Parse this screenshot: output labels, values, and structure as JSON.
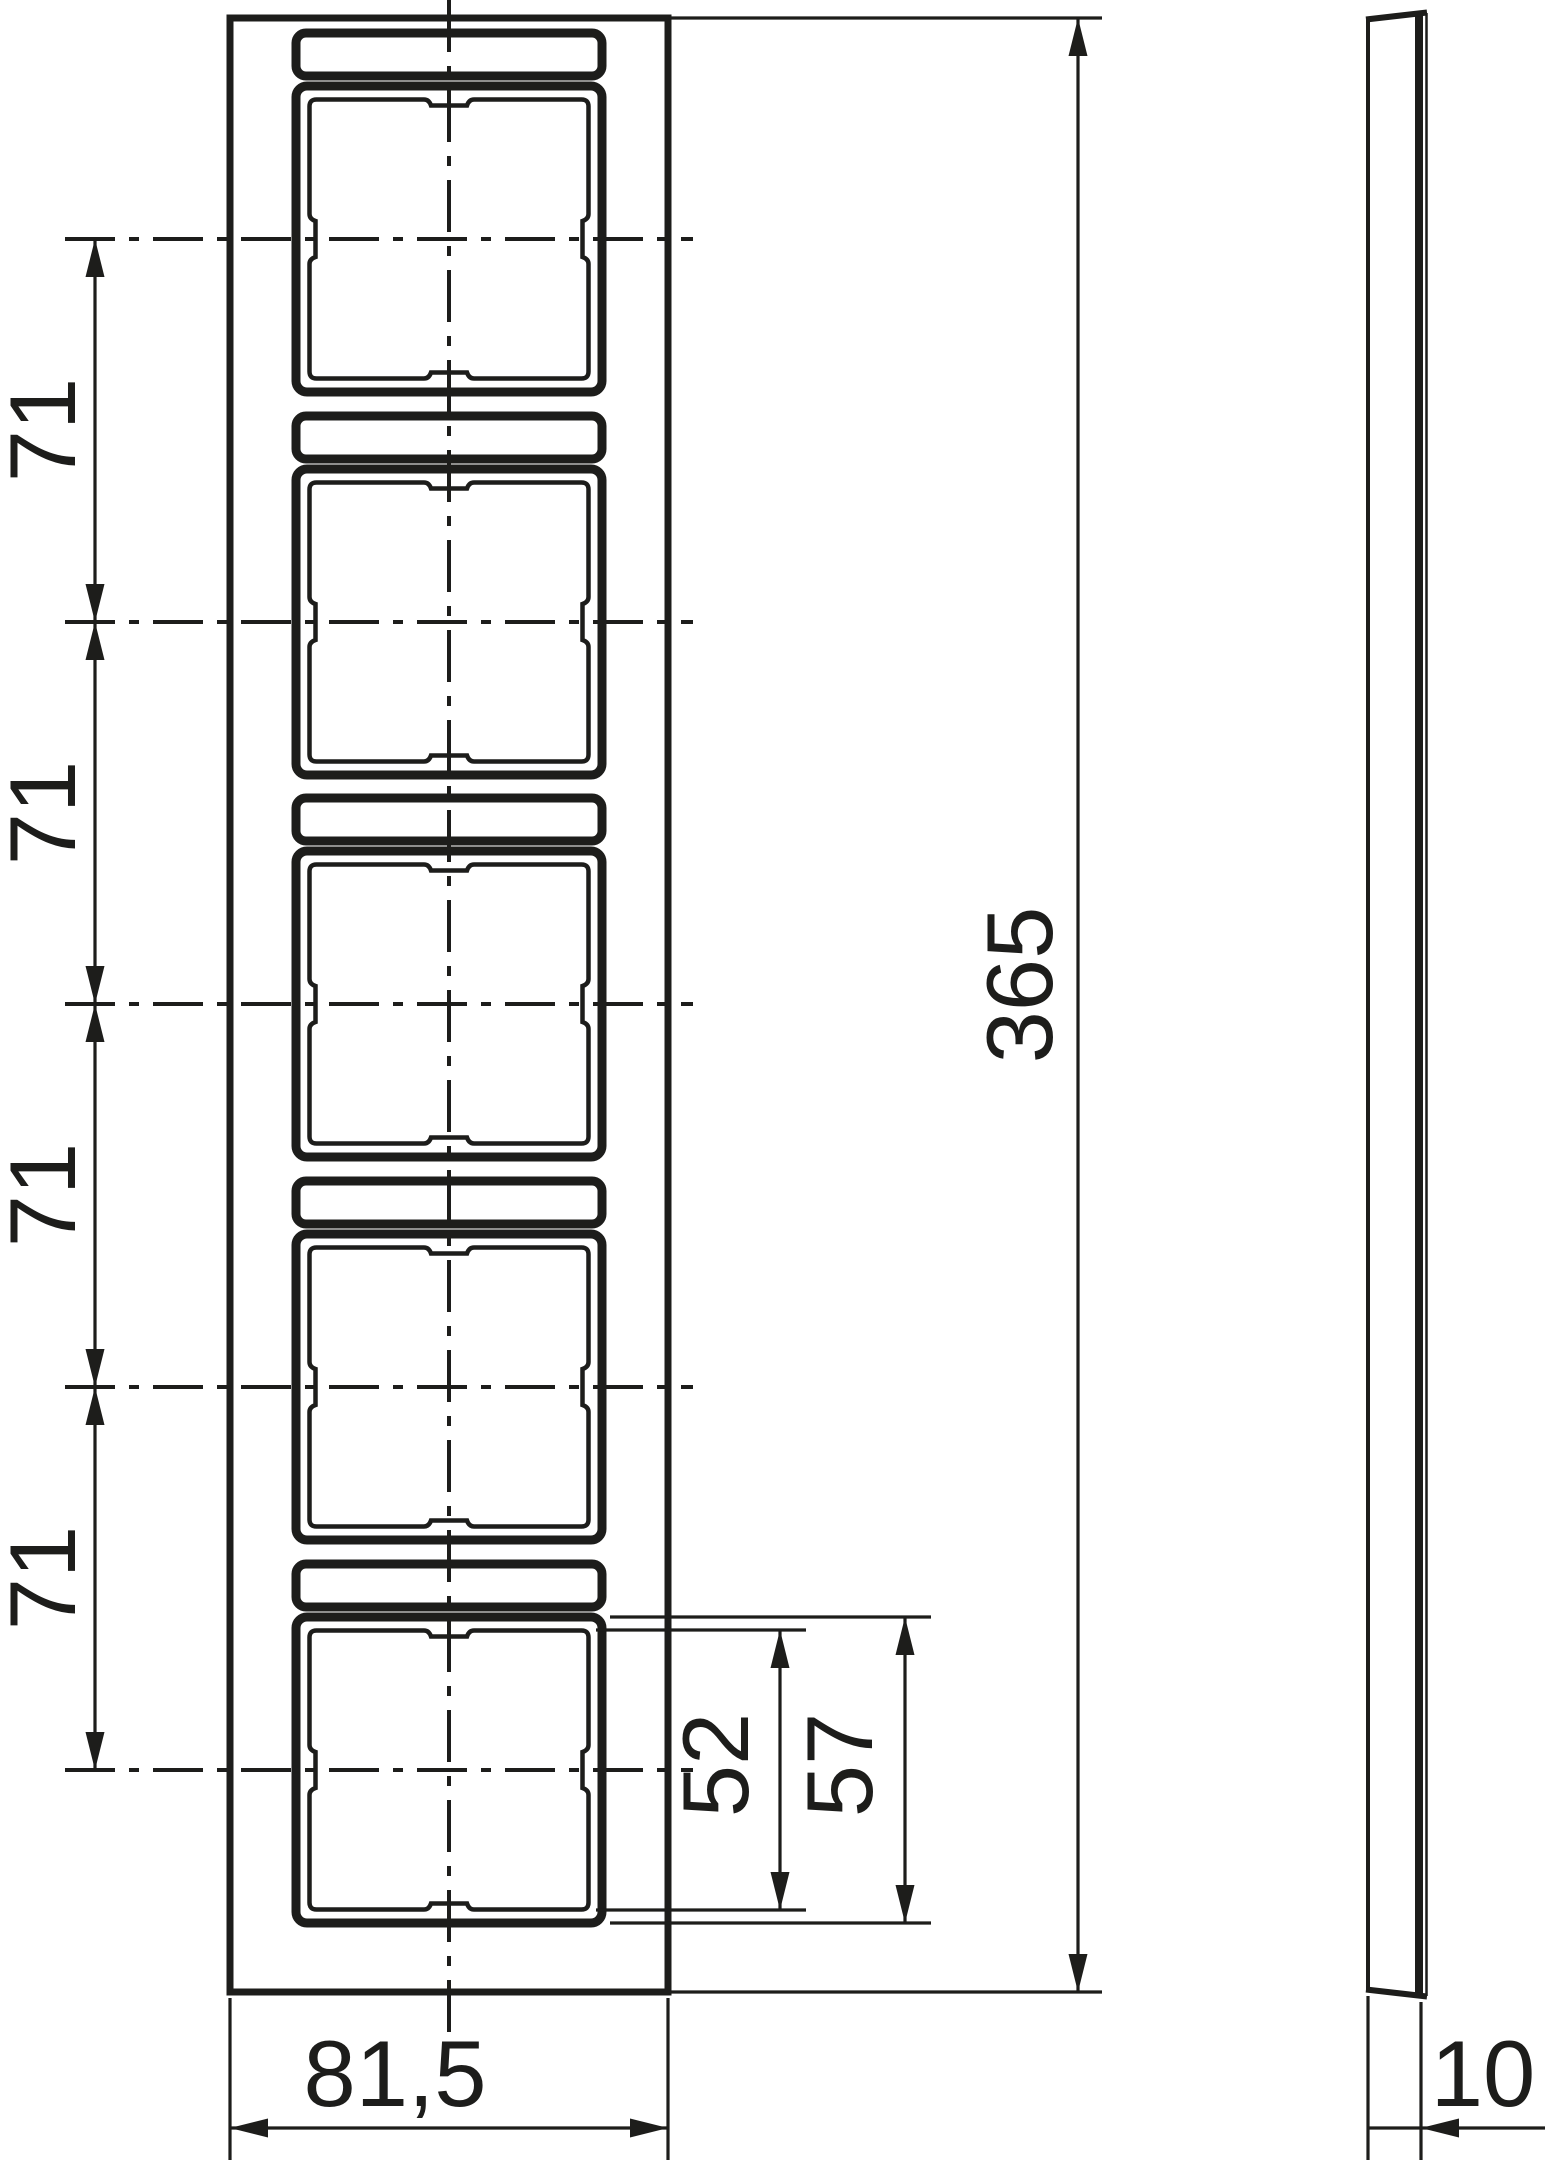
{
  "page": {
    "background": "#ffffff",
    "line_color": "#1d1d1b"
  },
  "drawing": {
    "description": "dimension-drawing-5-gang-frame",
    "front_view_openings": 5,
    "dimensions": {
      "pitch_labels": [
        "71",
        "71",
        "71",
        "71"
      ],
      "total_height": "365",
      "inner_cutout": "52",
      "outer_cutout": "57",
      "overall_width": "81,5",
      "depth": "10"
    }
  }
}
